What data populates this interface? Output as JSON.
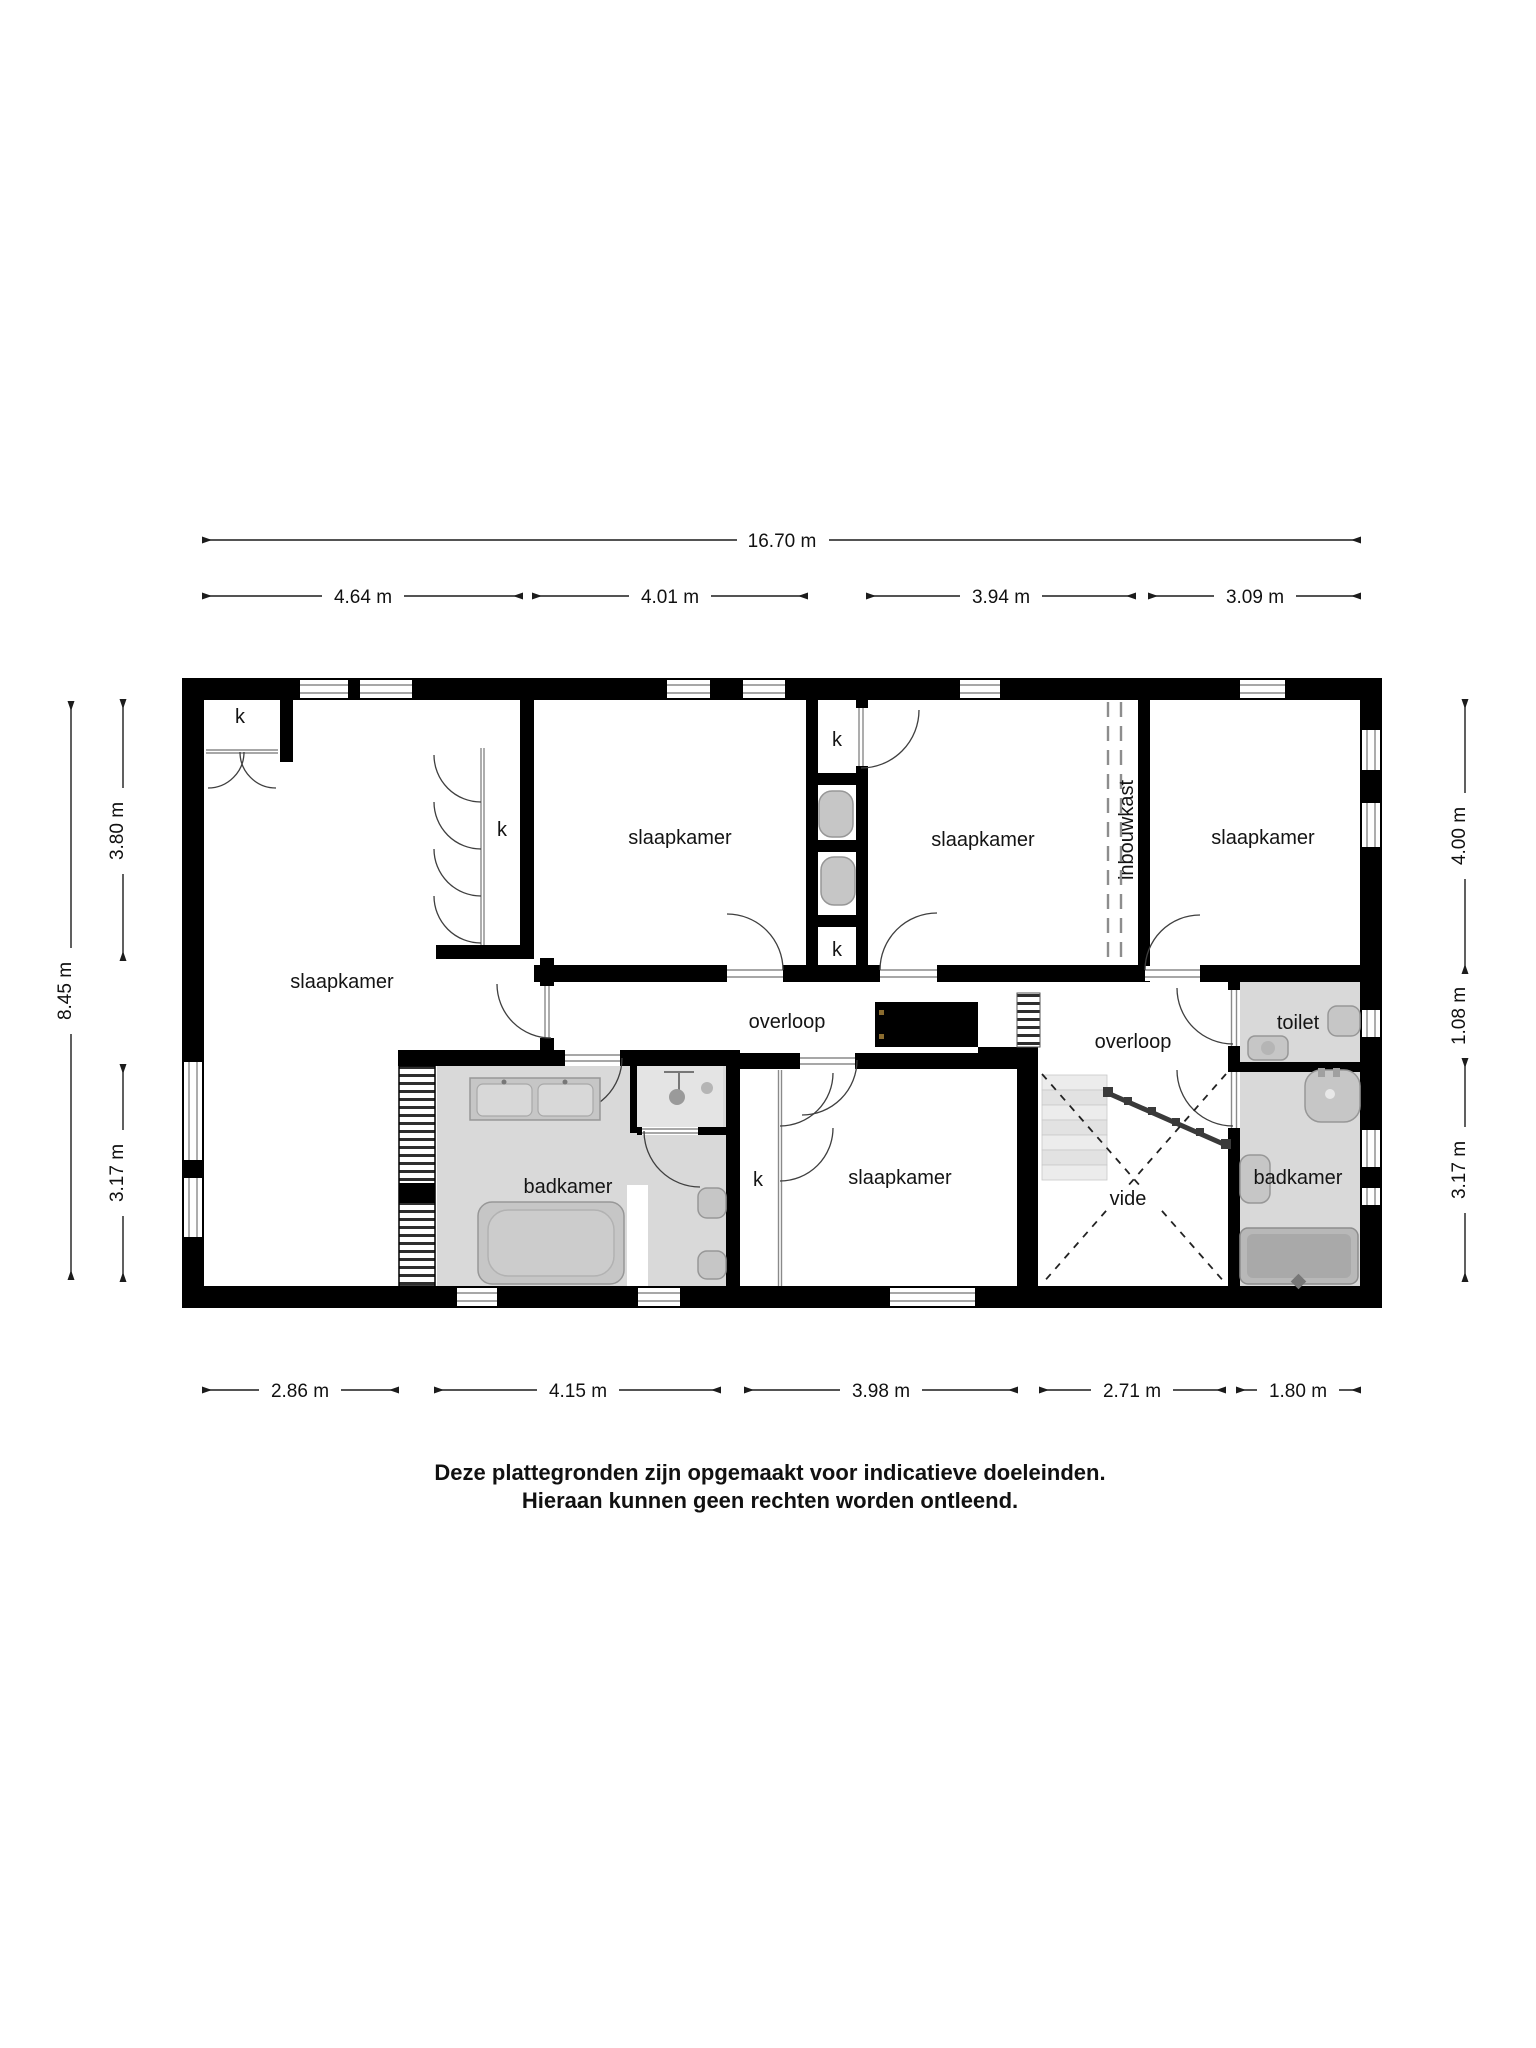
{
  "plan": {
    "rooms": {
      "bedroom_left": "slaapkamer",
      "bedroom_2": "slaapkamer",
      "bedroom_3": "slaapkamer",
      "bedroom_4": "slaapkamer",
      "bedroom_bottom": "slaapkamer",
      "landing_left": "overloop",
      "landing_right": "overloop",
      "bathroom_left": "badkamer",
      "bathroom_right": "badkamer",
      "toilet": "toilet",
      "void": "vide",
      "built_in_closet": "inbouwkast",
      "closet_abbr": "k"
    },
    "dimensions": {
      "top_total": "16.70 m",
      "top_segments": [
        "4.64 m",
        "4.01 m",
        "3.94 m",
        "3.09 m"
      ],
      "bottom_segments": [
        "2.86 m",
        "4.15 m",
        "3.98 m",
        "2.71 m",
        "1.80 m"
      ],
      "left_total": "8.45 m",
      "left_segments": [
        "3.80 m",
        "3.17 m"
      ],
      "right_segments": [
        "4.00 m",
        "1.08 m",
        "3.17 m"
      ]
    },
    "disclaimer": {
      "line1": "Deze plattegronden zijn opgemaakt voor indicatieve doeleinden.",
      "line2": "Hieraan kunnen geen rechten worden ontleend."
    },
    "colors": {
      "wall": "#000000",
      "bathroom_floor": "#d9d9d9",
      "window_line": "#8a8a8a",
      "dimension_line": "#1c1c1c"
    }
  }
}
